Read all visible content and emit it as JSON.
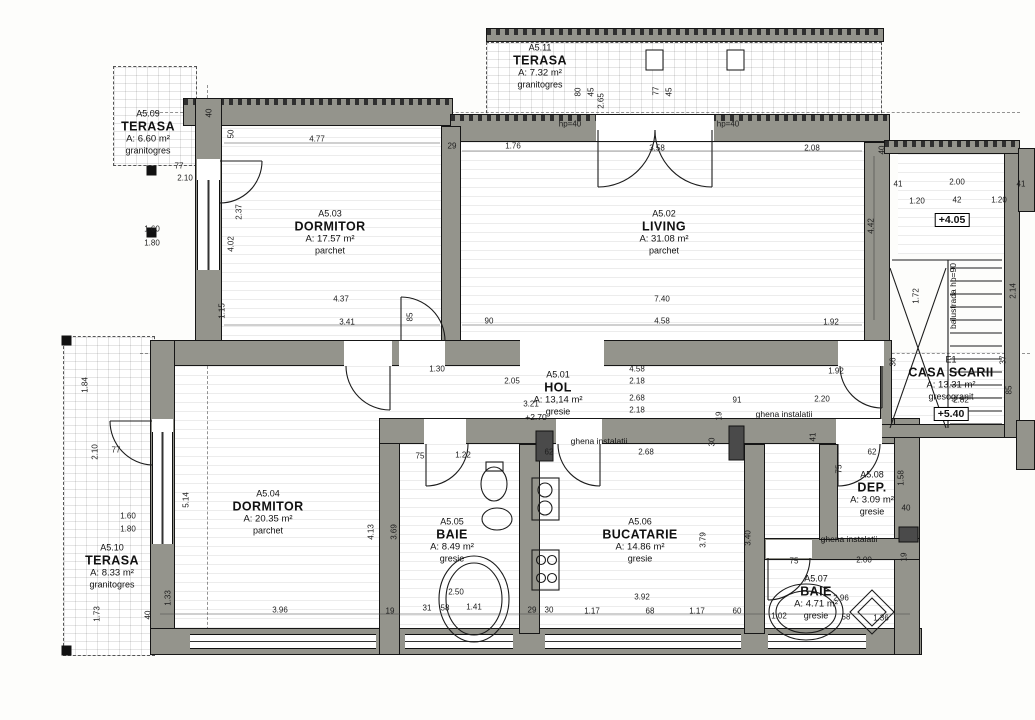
{
  "drawing": {
    "wall_color": "#94948c",
    "line_color": "#161616",
    "bg_color": "#fdfdfb"
  },
  "rooms": [
    {
      "code": "A5.01",
      "name": "HOL",
      "area": "A: 13,14 m²",
      "finish": "gresie",
      "x": 558,
      "y": 393
    },
    {
      "code": "A5.02",
      "name": "LIVING",
      "area": "A: 31.08 m²",
      "finish": "parchet",
      "x": 664,
      "y": 232
    },
    {
      "code": "A5.03",
      "name": "DORMITOR",
      "area": "A: 17.57 m²",
      "finish": "parchet",
      "x": 330,
      "y": 232
    },
    {
      "code": "A5.04",
      "name": "DORMITOR",
      "area": "A: 20.35 m²",
      "finish": "parchet",
      "x": 268,
      "y": 512
    },
    {
      "code": "A5.05",
      "name": "BAIE",
      "area": "A: 8.49 m²",
      "finish": "gresie",
      "x": 452,
      "y": 540
    },
    {
      "code": "A5.06",
      "name": "BUCATARIE",
      "area": "A: 14.86 m²",
      "finish": "gresie",
      "x": 640,
      "y": 540
    },
    {
      "code": "A5.07",
      "name": "BAIE",
      "area": "A: 4.71 m²",
      "finish": "gresie",
      "x": 816,
      "y": 597
    },
    {
      "code": "A5.08",
      "name": "DEP.",
      "area": "A: 3.09 m²",
      "finish": "gresie",
      "x": 872,
      "y": 493
    },
    {
      "code": "A5.09",
      "name": "TERASA",
      "area": "A: 6.60 m²",
      "finish": "granitogres",
      "x": 148,
      "y": 132
    },
    {
      "code": "A5.10",
      "name": "TERASA",
      "area": "A: 8.33 m²",
      "finish": "granitogres",
      "x": 112,
      "y": 566
    },
    {
      "code": "A5.11",
      "name": "TERASA",
      "area": "A: 7.32 m²",
      "finish": "granitogres",
      "x": 540,
      "y": 66
    },
    {
      "code": "E1",
      "name": "CASA SCARII",
      "area": "A: 13.31 m²",
      "finish": "gresogranit",
      "x": 951,
      "y": 378
    }
  ],
  "annotations": [
    {
      "text": "ghena instalatii",
      "x": 599,
      "y": 441
    },
    {
      "text": "ghena instalatii",
      "x": 784,
      "y": 414
    },
    {
      "text": "ghena instalatii",
      "x": 849,
      "y": 539
    },
    {
      "text": "balustrada hp=90",
      "x": 953,
      "y": 296,
      "v": true
    },
    {
      "text": "+4.05",
      "x": 952,
      "y": 220,
      "boxed": true
    },
    {
      "text": "+5.40",
      "x": 951,
      "y": 414,
      "boxed": true
    },
    {
      "text": "+2.70",
      "x": 536,
      "y": 417
    }
  ],
  "dimensions": [
    {
      "t": "4.77",
      "x": 317,
      "y": 139
    },
    {
      "t": "29",
      "x": 452,
      "y": 146
    },
    {
      "t": "1.76",
      "x": 513,
      "y": 146
    },
    {
      "t": "3.58",
      "x": 657,
      "y": 148
    },
    {
      "t": "2.08",
      "x": 812,
      "y": 148
    },
    {
      "t": "40",
      "x": 882,
      "y": 150,
      "v": true
    },
    {
      "t": "50",
      "x": 231,
      "y": 134,
      "v": true
    },
    {
      "t": "40",
      "x": 209,
      "y": 113,
      "v": true
    },
    {
      "t": "hp=40",
      "x": 570,
      "y": 124
    },
    {
      "t": "hp=40",
      "x": 728,
      "y": 124
    },
    {
      "t": "2.65",
      "x": 601,
      "y": 101,
      "v": true
    },
    {
      "t": "80",
      "x": 578,
      "y": 92,
      "v": true
    },
    {
      "t": "45",
      "x": 591,
      "y": 92,
      "v": true
    },
    {
      "t": "77",
      "x": 656,
      "y": 91,
      "v": true
    },
    {
      "t": "45",
      "x": 669,
      "y": 92,
      "v": true
    },
    {
      "t": "77",
      "x": 179,
      "y": 166
    },
    {
      "t": "2.10",
      "x": 185,
      "y": 178
    },
    {
      "t": "1.60",
      "x": 152,
      "y": 229
    },
    {
      "t": "1.80",
      "x": 152,
      "y": 243
    },
    {
      "t": "2.37",
      "x": 239,
      "y": 212,
      "v": true
    },
    {
      "t": "4.02",
      "x": 231,
      "y": 244,
      "v": true
    },
    {
      "t": "1.15",
      "x": 222,
      "y": 311,
      "v": true
    },
    {
      "t": "4.37",
      "x": 341,
      "y": 299
    },
    {
      "t": "3.41",
      "x": 347,
      "y": 322
    },
    {
      "t": "85",
      "x": 410,
      "y": 317,
      "v": true
    },
    {
      "t": "90",
      "x": 489,
      "y": 321
    },
    {
      "t": "7.40",
      "x": 662,
      "y": 299
    },
    {
      "t": "4.58",
      "x": 662,
      "y": 321
    },
    {
      "t": "1.92",
      "x": 831,
      "y": 322
    },
    {
      "t": "4.42",
      "x": 871,
      "y": 226,
      "v": true
    },
    {
      "t": "1.30",
      "x": 437,
      "y": 369
    },
    {
      "t": "2.05",
      "x": 512,
      "y": 381
    },
    {
      "t": "3.21",
      "x": 531,
      "y": 404
    },
    {
      "t": "4.58",
      "x": 637,
      "y": 369
    },
    {
      "t": "2.18",
      "x": 637,
      "y": 381
    },
    {
      "t": "2.68",
      "x": 637,
      "y": 398
    },
    {
      "t": "2.18",
      "x": 637,
      "y": 410
    },
    {
      "t": "1.92",
      "x": 836,
      "y": 371
    },
    {
      "t": "91",
      "x": 737,
      "y": 400
    },
    {
      "t": "2.20",
      "x": 822,
      "y": 399
    },
    {
      "t": "19",
      "x": 719,
      "y": 416,
      "v": true
    },
    {
      "t": "41",
      "x": 813,
      "y": 437,
      "v": true
    },
    {
      "t": "30",
      "x": 712,
      "y": 442,
      "v": true
    },
    {
      "t": "5.14",
      "x": 186,
      "y": 500,
      "v": true
    },
    {
      "t": "4.13",
      "x": 371,
      "y": 532,
      "v": true
    },
    {
      "t": "3.96",
      "x": 280,
      "y": 610
    },
    {
      "t": "19",
      "x": 390,
      "y": 611
    },
    {
      "t": "1.33",
      "x": 168,
      "y": 598,
      "v": true
    },
    {
      "t": "40",
      "x": 148,
      "y": 615,
      "v": true
    },
    {
      "t": "75",
      "x": 420,
      "y": 456
    },
    {
      "t": "1.22",
      "x": 463,
      "y": 455
    },
    {
      "t": "3.69",
      "x": 394,
      "y": 532,
      "v": true
    },
    {
      "t": "2.50",
      "x": 456,
      "y": 592
    },
    {
      "t": "1.41",
      "x": 474,
      "y": 607
    },
    {
      "t": "31",
      "x": 427,
      "y": 608
    },
    {
      "t": "58",
      "x": 445,
      "y": 608
    },
    {
      "t": "29",
      "x": 532,
      "y": 610
    },
    {
      "t": "30",
      "x": 549,
      "y": 610
    },
    {
      "t": "62",
      "x": 549,
      "y": 452
    },
    {
      "t": "2.68",
      "x": 646,
      "y": 452
    },
    {
      "t": "3.92",
      "x": 642,
      "y": 597
    },
    {
      "t": "1.17",
      "x": 592,
      "y": 611
    },
    {
      "t": "68",
      "x": 650,
      "y": 611
    },
    {
      "t": "1.17",
      "x": 697,
      "y": 611
    },
    {
      "t": "60",
      "x": 737,
      "y": 611
    },
    {
      "t": "3.79",
      "x": 703,
      "y": 540,
      "v": true
    },
    {
      "t": "3.40",
      "x": 748,
      "y": 538,
      "v": true
    },
    {
      "t": "75",
      "x": 794,
      "y": 561
    },
    {
      "t": "2.00",
      "x": 864,
      "y": 560
    },
    {
      "t": "2.96",
      "x": 841,
      "y": 598
    },
    {
      "t": "1.02",
      "x": 779,
      "y": 616
    },
    {
      "t": "58",
      "x": 846,
      "y": 617
    },
    {
      "t": "1.36",
      "x": 881,
      "y": 618
    },
    {
      "t": "62",
      "x": 872,
      "y": 452
    },
    {
      "t": "75",
      "x": 839,
      "y": 469,
      "v": true
    },
    {
      "t": "1.58",
      "x": 901,
      "y": 478,
      "v": true
    },
    {
      "t": "40",
      "x": 906,
      "y": 508
    },
    {
      "t": "19",
      "x": 904,
      "y": 557,
      "v": true
    },
    {
      "t": "41",
      "x": 898,
      "y": 184
    },
    {
      "t": "2.00",
      "x": 957,
      "y": 182
    },
    {
      "t": "41",
      "x": 1021,
      "y": 184
    },
    {
      "t": "1.20",
      "x": 917,
      "y": 201
    },
    {
      "t": "42",
      "x": 957,
      "y": 200
    },
    {
      "t": "1.20",
      "x": 999,
      "y": 200
    },
    {
      "t": "2.14",
      "x": 1013,
      "y": 291,
      "v": true
    },
    {
      "t": "1.72",
      "x": 916,
      "y": 296,
      "v": true
    },
    {
      "t": "2.82",
      "x": 961,
      "y": 400
    },
    {
      "t": "36",
      "x": 893,
      "y": 362,
      "v": true
    },
    {
      "t": "37",
      "x": 1003,
      "y": 360,
      "v": true
    },
    {
      "t": "85",
      "x": 1009,
      "y": 390,
      "v": true
    },
    {
      "t": "1.84",
      "x": 85,
      "y": 385,
      "v": true
    },
    {
      "t": "2.10",
      "x": 95,
      "y": 452,
      "v": true
    },
    {
      "t": "77",
      "x": 116,
      "y": 450
    },
    {
      "t": "1.60",
      "x": 128,
      "y": 516
    },
    {
      "t": "1.80",
      "x": 128,
      "y": 529
    },
    {
      "t": "1.73",
      "x": 97,
      "y": 614,
      "v": true
    }
  ]
}
